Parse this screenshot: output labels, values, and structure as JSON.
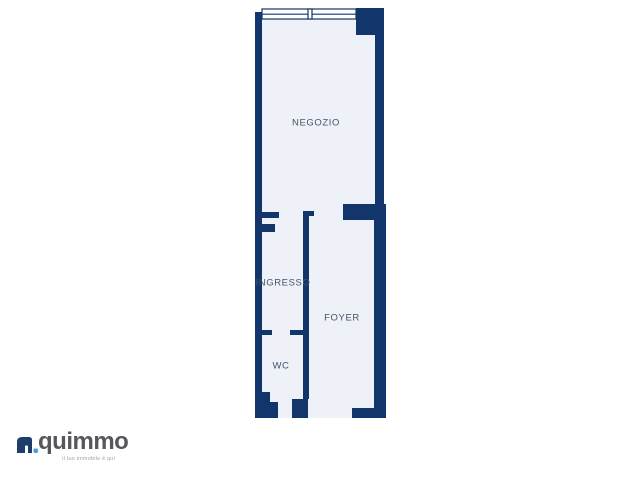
{
  "floorplan": {
    "rooms": [
      {
        "name": "NEGOZIO"
      },
      {
        "name": "INGRESSO"
      },
      {
        "name": "FOYER"
      },
      {
        "name": "WC"
      }
    ]
  },
  "logo": {
    "brand": "quimmo",
    "tagline": "il tuo immobile è qui"
  },
  "colors": {
    "wall": "#12356b",
    "floor": "#eef2f8",
    "window_fill": "#ffffff",
    "label_text": "#475266",
    "brand_text": "#57585c",
    "brand_icon": "#1d3e6d",
    "brand_dot": "#4aa0d8",
    "background": "#ffffff"
  }
}
